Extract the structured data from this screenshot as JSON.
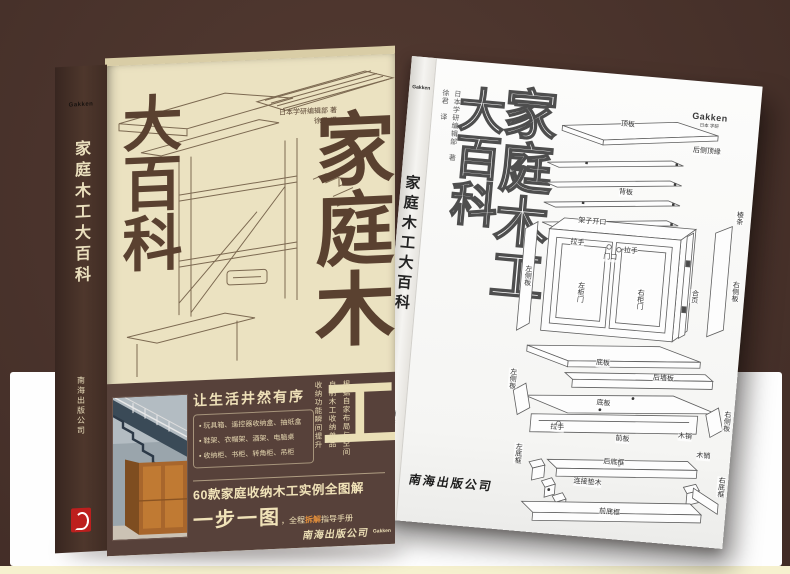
{
  "scene": {
    "background_color": "#47312a",
    "panel_color": "#fefefe",
    "bottom_strip_color": "#f6f1cf",
    "accent_orange": "#e4903c",
    "seal_red": "#bd1f1e"
  },
  "left_book": {
    "spine": {
      "logo": "Gakken",
      "title": "家庭木工大百科",
      "publisher": "南海出版公司"
    },
    "cover": {
      "authors": "日本学研编辑部 著",
      "translator": "徐君 译",
      "title_main": "家庭木",
      "title_main_tail": "工",
      "title_sub": "大百科",
      "panel": {
        "headline": "让生活井然有序",
        "bullets": [
          "玩具箱、遥控器收纳盒、抽纸盒",
          "鞋架、衣帽架、酒架、电脑桌",
          "收纳柜、书柜、转角柜、吊柜"
        ],
        "notes": [
          "根据自家布局与空间",
          "自制木工收纳单品",
          "收纳功能瞬间提升"
        ],
        "subtitle": "60款家庭收纳木工实例全图解",
        "slogan_big": "一步一图",
        "slogan_mid1": "，全程",
        "slogan_accent": "拆解",
        "slogan_mid2": "指导手册",
        "publisher": "南海出版公司",
        "logo": "Gakken"
      }
    }
  },
  "right_book": {
    "spine": {
      "logo": "Gakken",
      "title": "家庭木工大百科",
      "publisher": "南海出版公司"
    },
    "cover": {
      "logo": "Gakken",
      "logo_sub": "日本 学研",
      "authors": "日本学研编辑部 著",
      "translator": "徐君 译",
      "title_main": "家庭木工",
      "title_sub": "大百科",
      "publisher": "南海出版公司",
      "diagram": {
        "labels": [
          {
            "text": "顶板",
            "x": 92,
            "y": 6,
            "v": false
          },
          {
            "text": "后侧顶缘",
            "x": 166,
            "y": 26,
            "v": false
          },
          {
            "text": "背板",
            "x": 96,
            "y": 74,
            "v": false
          },
          {
            "text": "架子开口",
            "x": 58,
            "y": 106,
            "v": false
          },
          {
            "text": "门口",
            "x": 86,
            "y": 140,
            "v": false
          },
          {
            "text": "棱条",
            "x": 214,
            "y": 86,
            "v": true
          },
          {
            "text": "左侧板",
            "x": 8,
            "y": 158,
            "v": true
          },
          {
            "text": "拉手",
            "x": 52,
            "y": 128,
            "v": false
          },
          {
            "text": "拉手",
            "x": 106,
            "y": 132,
            "v": false
          },
          {
            "text": "左柜门",
            "x": 62,
            "y": 170,
            "v": true
          },
          {
            "text": "右柜门",
            "x": 122,
            "y": 172,
            "v": true
          },
          {
            "text": "合页",
            "x": 176,
            "y": 168,
            "v": true
          },
          {
            "text": "右侧板",
            "x": 216,
            "y": 156,
            "v": true
          },
          {
            "text": "底板",
            "x": 88,
            "y": 246,
            "v": false
          },
          {
            "text": "后墙板",
            "x": 146,
            "y": 256,
            "v": false
          },
          {
            "text": "左侧板",
            "x": 2,
            "y": 262,
            "v": true
          },
          {
            "text": "底板",
            "x": 92,
            "y": 286,
            "v": false
          },
          {
            "text": "右侧板",
            "x": 219,
            "y": 286,
            "v": true
          },
          {
            "text": "拉手",
            "x": 48,
            "y": 314,
            "v": false
          },
          {
            "text": "前板",
            "x": 114,
            "y": 320,
            "v": false
          },
          {
            "text": "木销",
            "x": 176,
            "y": 312,
            "v": false
          },
          {
            "text": "左底框",
            "x": 14,
            "y": 336,
            "v": true
          },
          {
            "text": "后底框",
            "x": 104,
            "y": 344,
            "v": false
          },
          {
            "text": "木销",
            "x": 196,
            "y": 330,
            "v": false
          },
          {
            "text": "连接垫木",
            "x": 76,
            "y": 366,
            "v": false
          },
          {
            "text": "右底框",
            "x": 219,
            "y": 352,
            "v": true
          },
          {
            "text": "前底框",
            "x": 104,
            "y": 394,
            "v": false
          }
        ]
      }
    }
  }
}
